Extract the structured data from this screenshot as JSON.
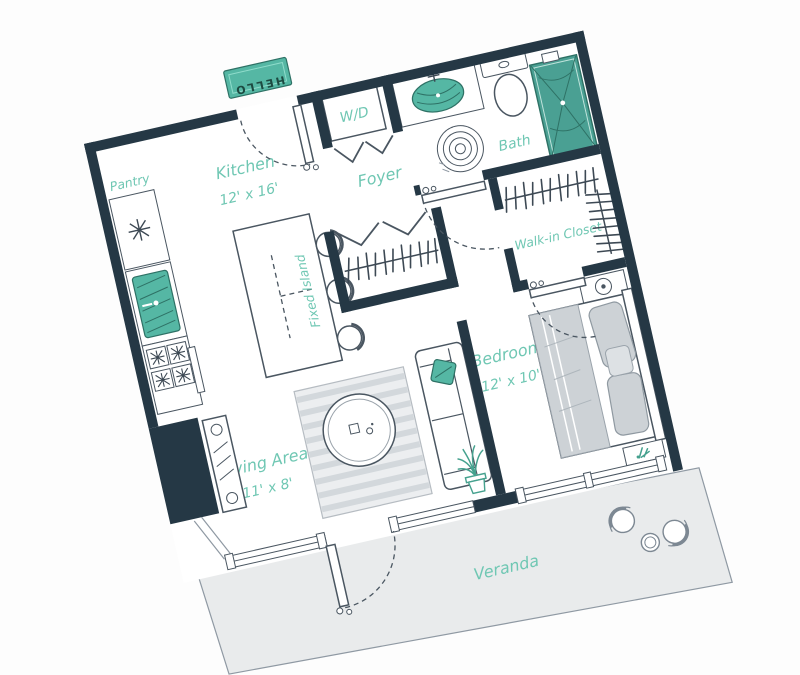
{
  "floorplan": {
    "rotation_deg": -12.8,
    "rooms": {
      "pantry": {
        "label": "Pantry"
      },
      "kitchen": {
        "label": "Kitchen",
        "dims": "12' x 16'"
      },
      "island": {
        "label": "Fixed Island"
      },
      "foyer": {
        "label": "Foyer"
      },
      "laundry": {
        "label": "W/D"
      },
      "bath": {
        "label": "Bath"
      },
      "walk_in_closet": {
        "label": "Walk-in Closet"
      },
      "bedroom": {
        "label": "Bedroom",
        "dims": "12' x 10'"
      },
      "living_area": {
        "label": "Living Area",
        "dims": "11' x 8'"
      },
      "veranda": {
        "label": "Veranda"
      }
    },
    "doormat": {
      "text": "HELLO"
    },
    "colors": {
      "wall": "#253845",
      "furniture_line": "#4a5661",
      "label_teal": "#6fc7b3",
      "accent_teal": "#55b7a4",
      "accent_teal_dark": "#2e7165",
      "soft_gray": "#ccd1d6",
      "veranda_fill": "#e9ebec",
      "background": "#fdfdfd"
    }
  }
}
